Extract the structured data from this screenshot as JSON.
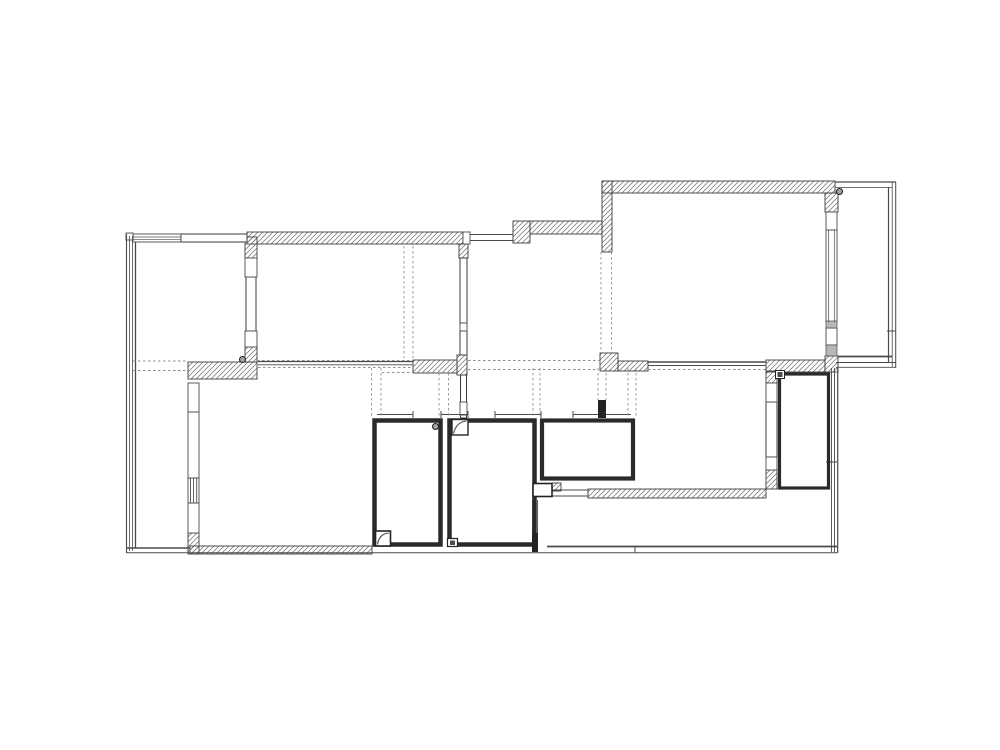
{
  "diagram_type": "architectural-floor-plan",
  "canvas": {
    "width": 1000,
    "height": 750,
    "background": "#ffffff"
  },
  "palette": {
    "wall_stroke": "#3c3c3c",
    "thin_line": "#4a4a4a",
    "dark_line": "#242424",
    "hatch_line": "#6e6e6e",
    "dash_line": "#8f8f8f",
    "gray_fill": "#b7b7b7",
    "symbol_fill": "#a3a3a3",
    "room_outline": "#2a2a2a",
    "white": "#ffffff"
  },
  "floor_plan": {
    "hatched_walls": [
      [
        247,
        232,
        216,
        12
      ],
      [
        459,
        244,
        9,
        14
      ],
      [
        513,
        221,
        17,
        22
      ],
      [
        530,
        221,
        72,
        13
      ],
      [
        602,
        181,
        10,
        71
      ],
      [
        602,
        181,
        233,
        12
      ],
      [
        825,
        193,
        13,
        19
      ],
      [
        825,
        356,
        13,
        16
      ],
      [
        766,
        360,
        59,
        12
      ],
      [
        600,
        353,
        18,
        18
      ],
      [
        618,
        361,
        30,
        10
      ],
      [
        188,
        362,
        69,
        17
      ],
      [
        245,
        347,
        12,
        15
      ],
      [
        245,
        237,
        12,
        21
      ],
      [
        188,
        533,
        11,
        21
      ],
      [
        190,
        546,
        182,
        8
      ],
      [
        413,
        360,
        44,
        13
      ],
      [
        457,
        355,
        10,
        20
      ],
      [
        588,
        489,
        178,
        9
      ],
      [
        552,
        483,
        9,
        8
      ],
      [
        766,
        371,
        11,
        12
      ],
      [
        766,
        470,
        11,
        19
      ]
    ],
    "plain_walls": [
      [
        246,
        277,
        10,
        54
      ],
      [
        460,
        258,
        7,
        65
      ],
      [
        460,
        331,
        7,
        24
      ],
      [
        460.5,
        375,
        6,
        43
      ],
      [
        766,
        402,
        11,
        55
      ],
      [
        181,
        234,
        66,
        8
      ]
    ],
    "room_outlines": [
      [
        374.5,
        420.5,
        66,
        124,
        4.5
      ],
      [
        449.5,
        420.5,
        85,
        124,
        4.5
      ],
      [
        542,
        420.5,
        91,
        58,
        4.2
      ],
      [
        779.5,
        374,
        49,
        114,
        3.2
      ]
    ],
    "dark_rects": [
      [
        598,
        400,
        8,
        18
      ],
      [
        532,
        533,
        6,
        19
      ]
    ],
    "windows": [
      [
        245,
        258,
        12,
        19
      ],
      [
        245,
        331,
        12,
        16
      ],
      [
        188,
        383,
        11,
        29
      ],
      [
        188,
        412,
        11,
        66
      ],
      [
        188,
        503,
        11,
        30
      ],
      [
        460,
        323,
        7,
        8
      ],
      [
        460,
        402,
        7,
        13
      ],
      [
        826,
        212,
        11,
        18
      ],
      [
        826,
        230,
        11,
        92
      ],
      [
        826,
        328,
        11,
        17
      ],
      [
        766,
        383,
        11,
        19
      ],
      [
        766,
        457,
        11,
        13
      ],
      [
        133,
        234,
        48,
        8
      ],
      [
        463,
        232,
        7,
        12
      ],
      [
        188,
        478,
        11,
        25
      ],
      [
        126,
        233,
        7,
        7
      ]
    ],
    "gray_rects": [
      [
        826,
        321,
        11,
        7
      ],
      [
        826,
        345,
        11,
        11
      ]
    ],
    "symbol_boxes": [
      [
        452,
        419.5,
        16,
        15.5,
        1.4
      ],
      [
        375.5,
        531,
        15,
        15,
        1.6
      ],
      [
        447.5,
        538.5,
        10,
        8,
        1.2
      ],
      [
        775.5,
        370.5,
        9,
        8,
        1.0
      ],
      [
        533,
        483.5,
        19,
        13,
        1.6
      ]
    ],
    "symbol_fills": [
      [
        450,
        540.5,
        5,
        4.5
      ],
      [
        777.5,
        372,
        5,
        5
      ]
    ],
    "circles": [
      [
        242.5,
        359.5,
        3
      ],
      [
        839.5,
        191.5,
        3
      ],
      [
        435.5,
        426.5,
        3
      ]
    ],
    "arcs": [
      "M 453.5 433.5 C 455.5 425.5 459.5 421.5 466.5 421",
      "M 377.5 544.5 C 378.5 537.5 382.5 533.5 389 533"
    ],
    "solid_lines": [
      [
        126.5,
        234,
        126.5,
        553,
        1.1
      ],
      [
        129.5,
        236,
        129.5,
        551,
        0.8
      ],
      [
        132.5,
        236,
        132.5,
        551,
        0.8
      ],
      [
        135.5,
        242,
        135.5,
        548,
        1.3
      ],
      [
        133,
        237,
        181,
        237,
        0.7
      ],
      [
        133,
        239.7,
        181,
        239.7,
        0.7
      ],
      [
        181,
        234,
        181,
        242,
        1
      ],
      [
        470,
        234.5,
        513,
        234.5,
        1
      ],
      [
        470,
        240.5,
        513,
        240.5,
        1
      ],
      [
        258,
        361.5,
        413,
        361.5,
        1.2
      ],
      [
        258,
        364.8,
        413,
        364.8,
        0.9
      ],
      [
        648,
        362,
        766,
        362,
        1.6
      ],
      [
        648,
        365.5,
        766,
        365.5,
        0.9
      ],
      [
        377,
        414.5,
        413,
        414.5,
        1
      ],
      [
        441,
        414.5,
        468,
        414.5,
        1
      ],
      [
        495,
        414.5,
        541,
        414.5,
        1
      ],
      [
        573,
        414.5,
        598,
        414.5,
        1
      ],
      [
        606,
        414.5,
        631,
        414.5,
        1
      ],
      [
        413,
        411,
        413,
        418,
        1
      ],
      [
        441,
        411,
        441,
        418,
        1
      ],
      [
        468,
        411,
        468,
        418,
        1
      ],
      [
        495,
        411,
        495,
        418,
        1
      ],
      [
        541,
        411,
        541,
        418,
        1
      ],
      [
        573,
        411,
        573,
        418,
        1
      ],
      [
        835,
        182,
        896,
        182,
        1.2
      ],
      [
        835,
        187.5,
        892,
        187.5,
        0.8
      ],
      [
        888.5,
        187,
        888.5,
        362,
        1.2
      ],
      [
        892.2,
        182,
        892.2,
        367,
        0.8
      ],
      [
        895.7,
        182,
        895.7,
        368,
        1
      ],
      [
        838,
        356.5,
        892,
        356.5,
        1.8
      ],
      [
        836,
        362.5,
        896,
        362.5,
        0.9
      ],
      [
        836,
        367.3,
        896,
        367.3,
        0.9
      ],
      [
        887,
        331,
        896,
        331,
        1
      ],
      [
        831.5,
        368,
        831.5,
        552,
        0.9
      ],
      [
        834.5,
        368,
        834.5,
        552,
        0.9
      ],
      [
        837.7,
        368,
        837.7,
        553,
        1.2
      ],
      [
        826,
        462,
        838,
        462,
        1
      ],
      [
        547,
        546.5,
        837,
        546.5,
        1.8
      ],
      [
        126,
        552.7,
        837,
        552.7,
        1
      ],
      [
        126,
        548,
        190,
        548,
        1.4
      ],
      [
        635,
        546,
        635,
        553,
        1
      ],
      [
        552,
        490,
        588,
        490,
        1
      ],
      [
        552,
        496,
        588,
        496,
        1
      ],
      [
        552,
        489,
        552,
        497,
        1
      ],
      [
        588,
        489,
        588,
        497,
        1
      ],
      [
        532.5,
        500,
        532.5,
        533,
        0.9
      ],
      [
        537.5,
        500,
        537.5,
        533,
        0.9
      ],
      [
        190.5,
        478,
        190.5,
        503,
        0.9
      ],
      [
        193.6,
        478,
        193.6,
        503,
        0.9
      ],
      [
        196.7,
        478,
        196.7,
        503,
        0.9
      ],
      [
        828.6,
        230,
        828.6,
        322,
        0.7
      ],
      [
        834.3,
        230,
        834.3,
        322,
        0.7
      ]
    ],
    "dashed_lines": [
      [
        601,
        252,
        601,
        353
      ],
      [
        611.5,
        252,
        611.5,
        353
      ],
      [
        404,
        246,
        404,
        358
      ],
      [
        413,
        246,
        413,
        358
      ],
      [
        371.5,
        368,
        371.5,
        416
      ],
      [
        381,
        368,
        381,
        416
      ],
      [
        439,
        373,
        439,
        416
      ],
      [
        448.5,
        373,
        448.5,
        416
      ],
      [
        533,
        368,
        533,
        416
      ],
      [
        540,
        368,
        540,
        416
      ],
      [
        598,
        368,
        598,
        400
      ],
      [
        606,
        368,
        606,
        400
      ],
      [
        628,
        368,
        628,
        416
      ],
      [
        636,
        368,
        636,
        416
      ],
      [
        133,
        361,
        188,
        361
      ],
      [
        133,
        370.5,
        188,
        370.5
      ],
      [
        257,
        360.5,
        413,
        360.5
      ],
      [
        468,
        360.5,
        600,
        360.5
      ],
      [
        258,
        367.5,
        413,
        367.5
      ],
      [
        468,
        369.5,
        597,
        369.5
      ],
      [
        648,
        369.5,
        766,
        369.5
      ],
      [
        382,
        372.5,
        448,
        372.5
      ]
    ]
  }
}
